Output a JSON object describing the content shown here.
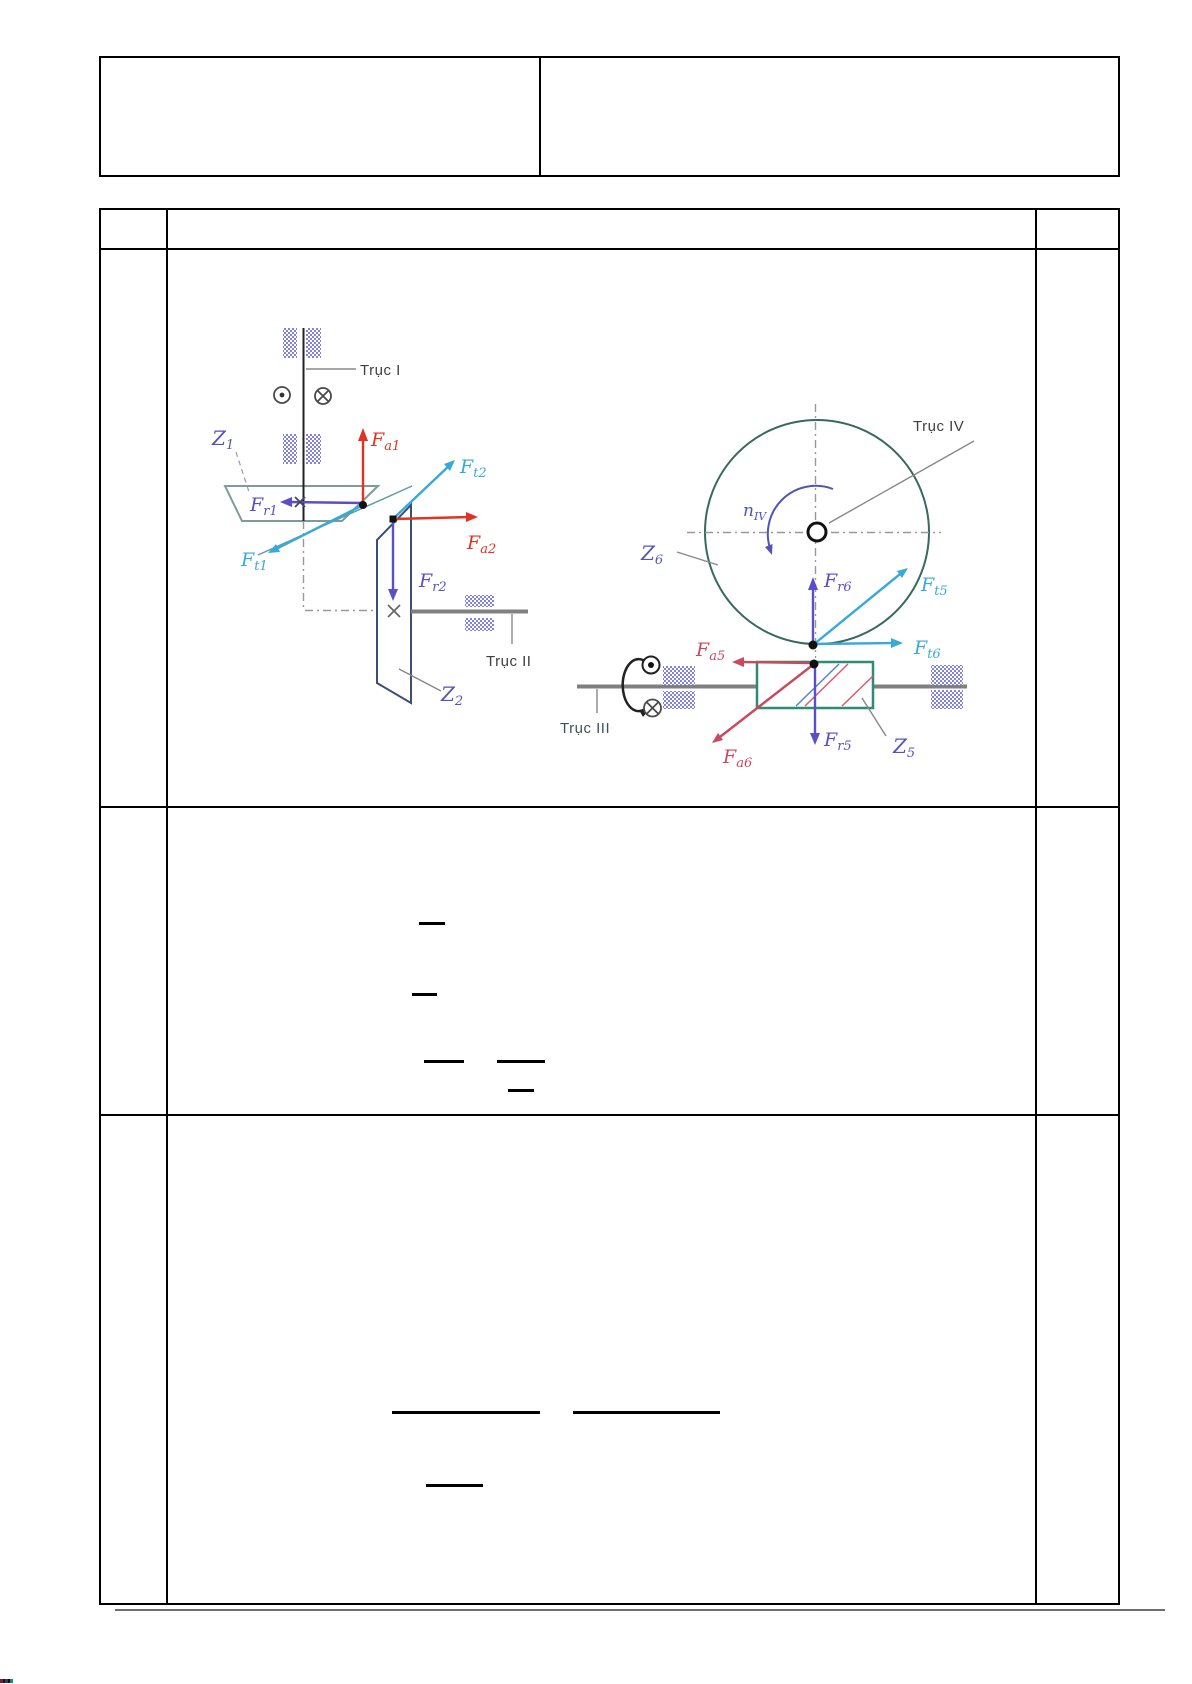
{
  "page": {
    "background": "#ffffff"
  },
  "colors": {
    "tangential": "#38a9d8",
    "axial_12": "#e23222",
    "axial_56": "#c94a5e",
    "radial": "#5a4fc8",
    "label_blue": "#5353b8",
    "gear1_outline": "#7d9b99",
    "gear2_outline": "#3b4f72",
    "gear6_circle": "#37695f",
    "worm_outline": "#2f8b72",
    "bearing_blue": "#5a5ad2",
    "shaft_gray": "#808080",
    "text_dark": "#3f3f3f"
  },
  "header_table": {
    "left_cell": "",
    "right_cell": ""
  },
  "main_table": {
    "header_row": "",
    "left_column_cells": [
      "",
      "",
      ""
    ],
    "right_column_cells": [
      "",
      "",
      ""
    ]
  },
  "diagram": {
    "shaft_labels": {
      "i": "Trục I",
      "ii": "Trục II",
      "iii": "Trục III",
      "iv": "Trục IV"
    },
    "gear_labels": {
      "z1": {
        "main": "Z",
        "sub": "1"
      },
      "z2": {
        "main": "Z",
        "sub": "2"
      },
      "z5": {
        "main": "Z",
        "sub": "5"
      },
      "z6": {
        "main": "Z",
        "sub": "6"
      }
    },
    "speed_label": {
      "main": "n",
      "sub": "IV"
    },
    "forces": {
      "fa1": {
        "main": "F",
        "sub": "a1"
      },
      "fr1": {
        "main": "F",
        "sub": "r1"
      },
      "ft1": {
        "main": "F",
        "sub": "t1"
      },
      "ft2": {
        "main": "F",
        "sub": "t2"
      },
      "fa2": {
        "main": "F",
        "sub": "a2"
      },
      "fr2": {
        "main": "F",
        "sub": "r2"
      },
      "fr6": {
        "main": "F",
        "sub": "r6"
      },
      "ft5": {
        "main": "F",
        "sub": "t5"
      },
      "ft6": {
        "main": "F",
        "sub": "t6"
      },
      "fa5": {
        "main": "F",
        "sub": "a5"
      },
      "fa6": {
        "main": "F",
        "sub": "a6"
      },
      "fr5": {
        "main": "F",
        "sub": "r5"
      }
    }
  }
}
